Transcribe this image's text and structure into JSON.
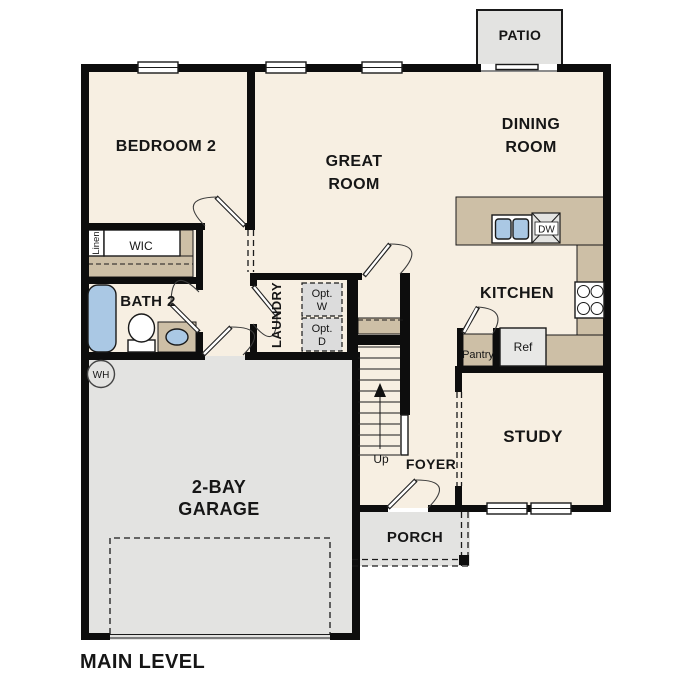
{
  "plan": {
    "title": "MAIN LEVEL"
  },
  "colors": {
    "wall": "#0d0d0d",
    "interior_floor": "#f7efe2",
    "exterior_concrete": "#e3e3e1",
    "counter_tan": "#cdbfa6",
    "fixture_blue": "#aac8e4",
    "appliance_gray": "#dcdcdc"
  },
  "rooms": {
    "patio": "PATIO",
    "bedroom2": "BEDROOM 2",
    "great_room": {
      "line1": "GREAT",
      "line2": "ROOM"
    },
    "dining_room": {
      "line1": "DINING",
      "line2": "ROOM"
    },
    "kitchen": "KITCHEN",
    "laundry": "LAUNDRY",
    "bath2": "BATH 2",
    "wic": "WIC",
    "linen": "Linen",
    "pantry": "Pantry",
    "study": "STUDY",
    "foyer": "FOYER",
    "porch": "PORCH",
    "garage": {
      "line1": "2-BAY",
      "line2": "GARAGE"
    }
  },
  "fixtures": {
    "dishwasher": "DW",
    "refrigerator": "Ref",
    "water_heater": "WH",
    "opt_washer": {
      "line1": "Opt.",
      "line2": "W"
    },
    "opt_dryer": {
      "line1": "Opt.",
      "line2": "D"
    },
    "stairs_up": "Up"
  }
}
